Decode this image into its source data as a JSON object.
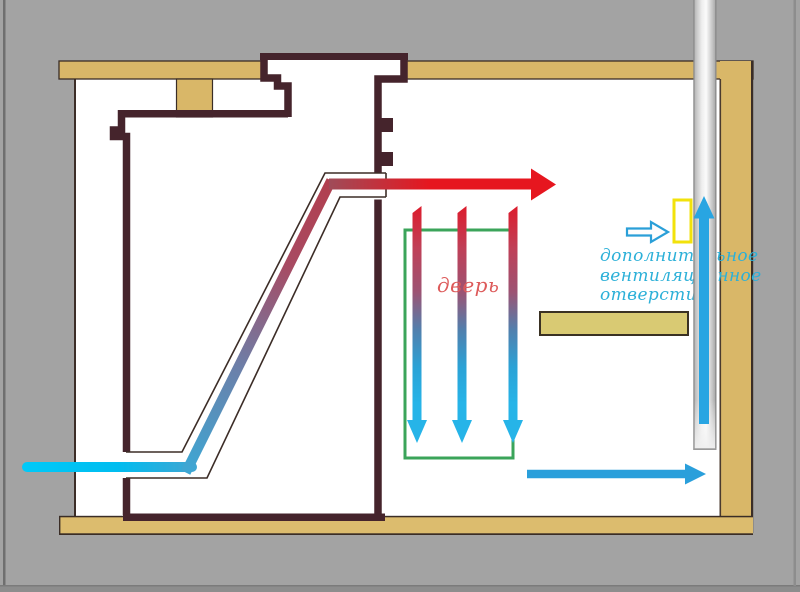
{
  "labels": {
    "door": "дверь",
    "vent_opening_line1": "дополнительное",
    "vent_opening_line2": "вентиляционное",
    "vent_opening_line3": "отверстие"
  },
  "colors": {
    "background_gray": "#a3a3a3",
    "wall_tan": "#d9b768",
    "floor_tan": "#dcbc6e",
    "shelf_tan": "#d9ca73",
    "stove_outline_brown": "#45242c",
    "hot_flow_red": "#e6161f",
    "cold_flow_cyan": "#00c7f7",
    "air_arrow_blue": "#28a5e2",
    "door_frame_green": "#3ba45a",
    "vent_marker_yellow": "#f2e20b",
    "vent_label_cyan": "#2cb0d8",
    "door_label_red": "#dd5a5a"
  }
}
